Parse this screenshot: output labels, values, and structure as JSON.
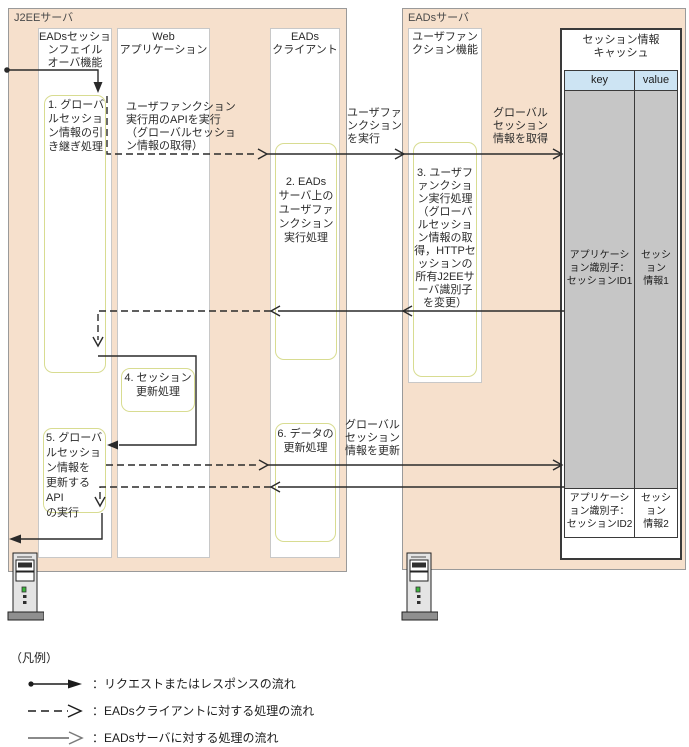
{
  "colors": {
    "group_background": "#f6e0cc",
    "step_border": "#d8dc91",
    "table_header": "#cde4f3",
    "table_row_gray": "#c6c6c6",
    "arrow": "#2a2a2a",
    "server_flow_gray": "#7a7a7a"
  },
  "groups": {
    "j2ee": "J2EEサーバ",
    "eads": "EADsサーバ"
  },
  "lanes": {
    "failover": "EADsセッショ\nンフェイル\nオーバ機能",
    "web_app": "Web\nアプリケーション",
    "eads_client": "EADs\nクライアント",
    "user_function": "ユーザファン\nクション機能"
  },
  "cache": {
    "title": "セッション情報\nキャッシュ",
    "col_key": "key",
    "col_value": "value",
    "rows": [
      {
        "key": "アプリケーシ\nョン識別子：\nセッションID1",
        "value": "セッシ\nョン\n情報1"
      },
      {
        "key": "アプリケーシ\nョン識別子：\nセッションID2",
        "value": "セッシ\nョン\n情報2"
      }
    ]
  },
  "steps": {
    "s1": "1. グローバ\nルセッショ\nン情報の引\nき継ぎ処理",
    "s2": "2. EADs\nサーバ上の\nユーザファ\nンクション\n実行処理",
    "s3": "3. ユーザフ\nァンクショ\nン実行処理\n（グローバ\nルセッショ\nン情報の取\n得，HTTPセ\nッションの\n所有J2EEサ\nーバ識別子\nを変更）",
    "s4": "4. セッション\n更新処理",
    "s5": "5. グローバ\nルセッショ\nン情報を\n更新するAPI\nの実行",
    "s6": "6. データの\n更新処理"
  },
  "flow_labels": {
    "api_exec": "ユーザファンクション\n実行用のAPIを実行\n（グローバルセッショ\nン情報の取得）",
    "func_exec": "ユーザファ\nンクション\nを実行",
    "get_info": "グローバル\nセッション\n情報を取得",
    "update_info": "グローバル\nセッション\n情報を更新"
  },
  "legend": {
    "title": "（凡例）",
    "items": [
      {
        "icon": "request-response-arrow",
        "label": "：リクエストまたはレスポンスの流れ"
      },
      {
        "icon": "eads-client-flow-arrow",
        "label": "：EADsクライアントに対する処理の流れ"
      },
      {
        "icon": "eads-server-flow-arrow",
        "label": "：EADsサーバに対する処理の流れ"
      }
    ]
  }
}
